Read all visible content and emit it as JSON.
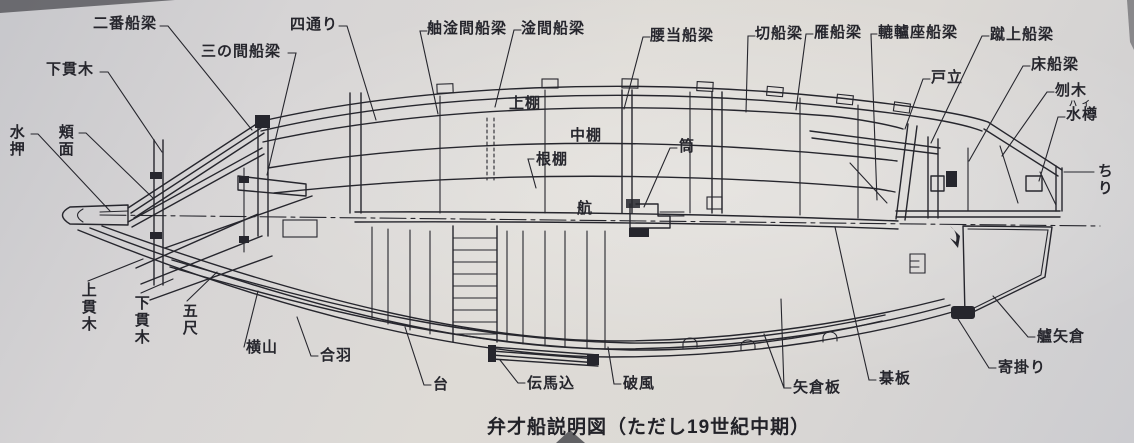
{
  "caption": {
    "text": "弁才船説明図（ただし19世紀中期）"
  },
  "colors": {
    "ink": "#26262d",
    "paper": "#dedbd6",
    "edge_shadow": "#4b4b50"
  },
  "labels": [
    {
      "id": "niban-funabari",
      "text": "二番船梁"
    },
    {
      "id": "shimo-nukigi-top",
      "text": "下貫木"
    },
    {
      "id": "sannoma-funabari",
      "text": "三の間船梁"
    },
    {
      "id": "yodori",
      "text": "四通り"
    },
    {
      "id": "he-akama-funabari",
      "text": "舳淦間船梁"
    },
    {
      "id": "akama-funabari",
      "text": "淦間船梁"
    },
    {
      "id": "koshiate-funabari",
      "text": "腰当船梁"
    },
    {
      "id": "kiri-funabari",
      "text": "切船梁"
    },
    {
      "id": "gan-funabari",
      "text": "雁船梁"
    },
    {
      "id": "rokuroza-funabari",
      "text": "轆轤座船梁"
    },
    {
      "id": "keage-funabari",
      "text": "蹴上船梁"
    },
    {
      "id": "todate",
      "text": "戸立"
    },
    {
      "id": "toko-funabari",
      "text": "床船梁"
    },
    {
      "id": "hanegi",
      "text": "刎木"
    },
    {
      "id": "mizutaru",
      "text": "水樽",
      "ruby": "ハイ"
    },
    {
      "id": "chiri",
      "text": "ちり"
    },
    {
      "id": "miyoshi",
      "text": "水押"
    },
    {
      "id": "hozura",
      "text": "頬面"
    },
    {
      "id": "kami-nukigi",
      "text": "上貫木"
    },
    {
      "id": "shimo-nukigi",
      "text": "下貫木"
    },
    {
      "id": "goshaku",
      "text": "五尺"
    },
    {
      "id": "yokoyama",
      "text": "横山"
    },
    {
      "id": "kappa",
      "text": "合羽"
    },
    {
      "id": "dai",
      "text": "台"
    },
    {
      "id": "tenmagomi",
      "text": "伝馬込"
    },
    {
      "id": "hafu",
      "text": "破風"
    },
    {
      "id": "yagura-ita",
      "text": "矢倉板"
    },
    {
      "id": "goban-ita",
      "text": "棊板"
    },
    {
      "id": "yorikakari",
      "text": "寄掛り"
    },
    {
      "id": "tomo-yagura",
      "text": "艫矢倉"
    },
    {
      "id": "uwadana",
      "text": "上棚"
    },
    {
      "id": "nakadana",
      "text": "中棚"
    },
    {
      "id": "nedana",
      "text": "根棚"
    },
    {
      "id": "kawara",
      "text": "航"
    },
    {
      "id": "tsutsu",
      "text": "筒"
    }
  ]
}
